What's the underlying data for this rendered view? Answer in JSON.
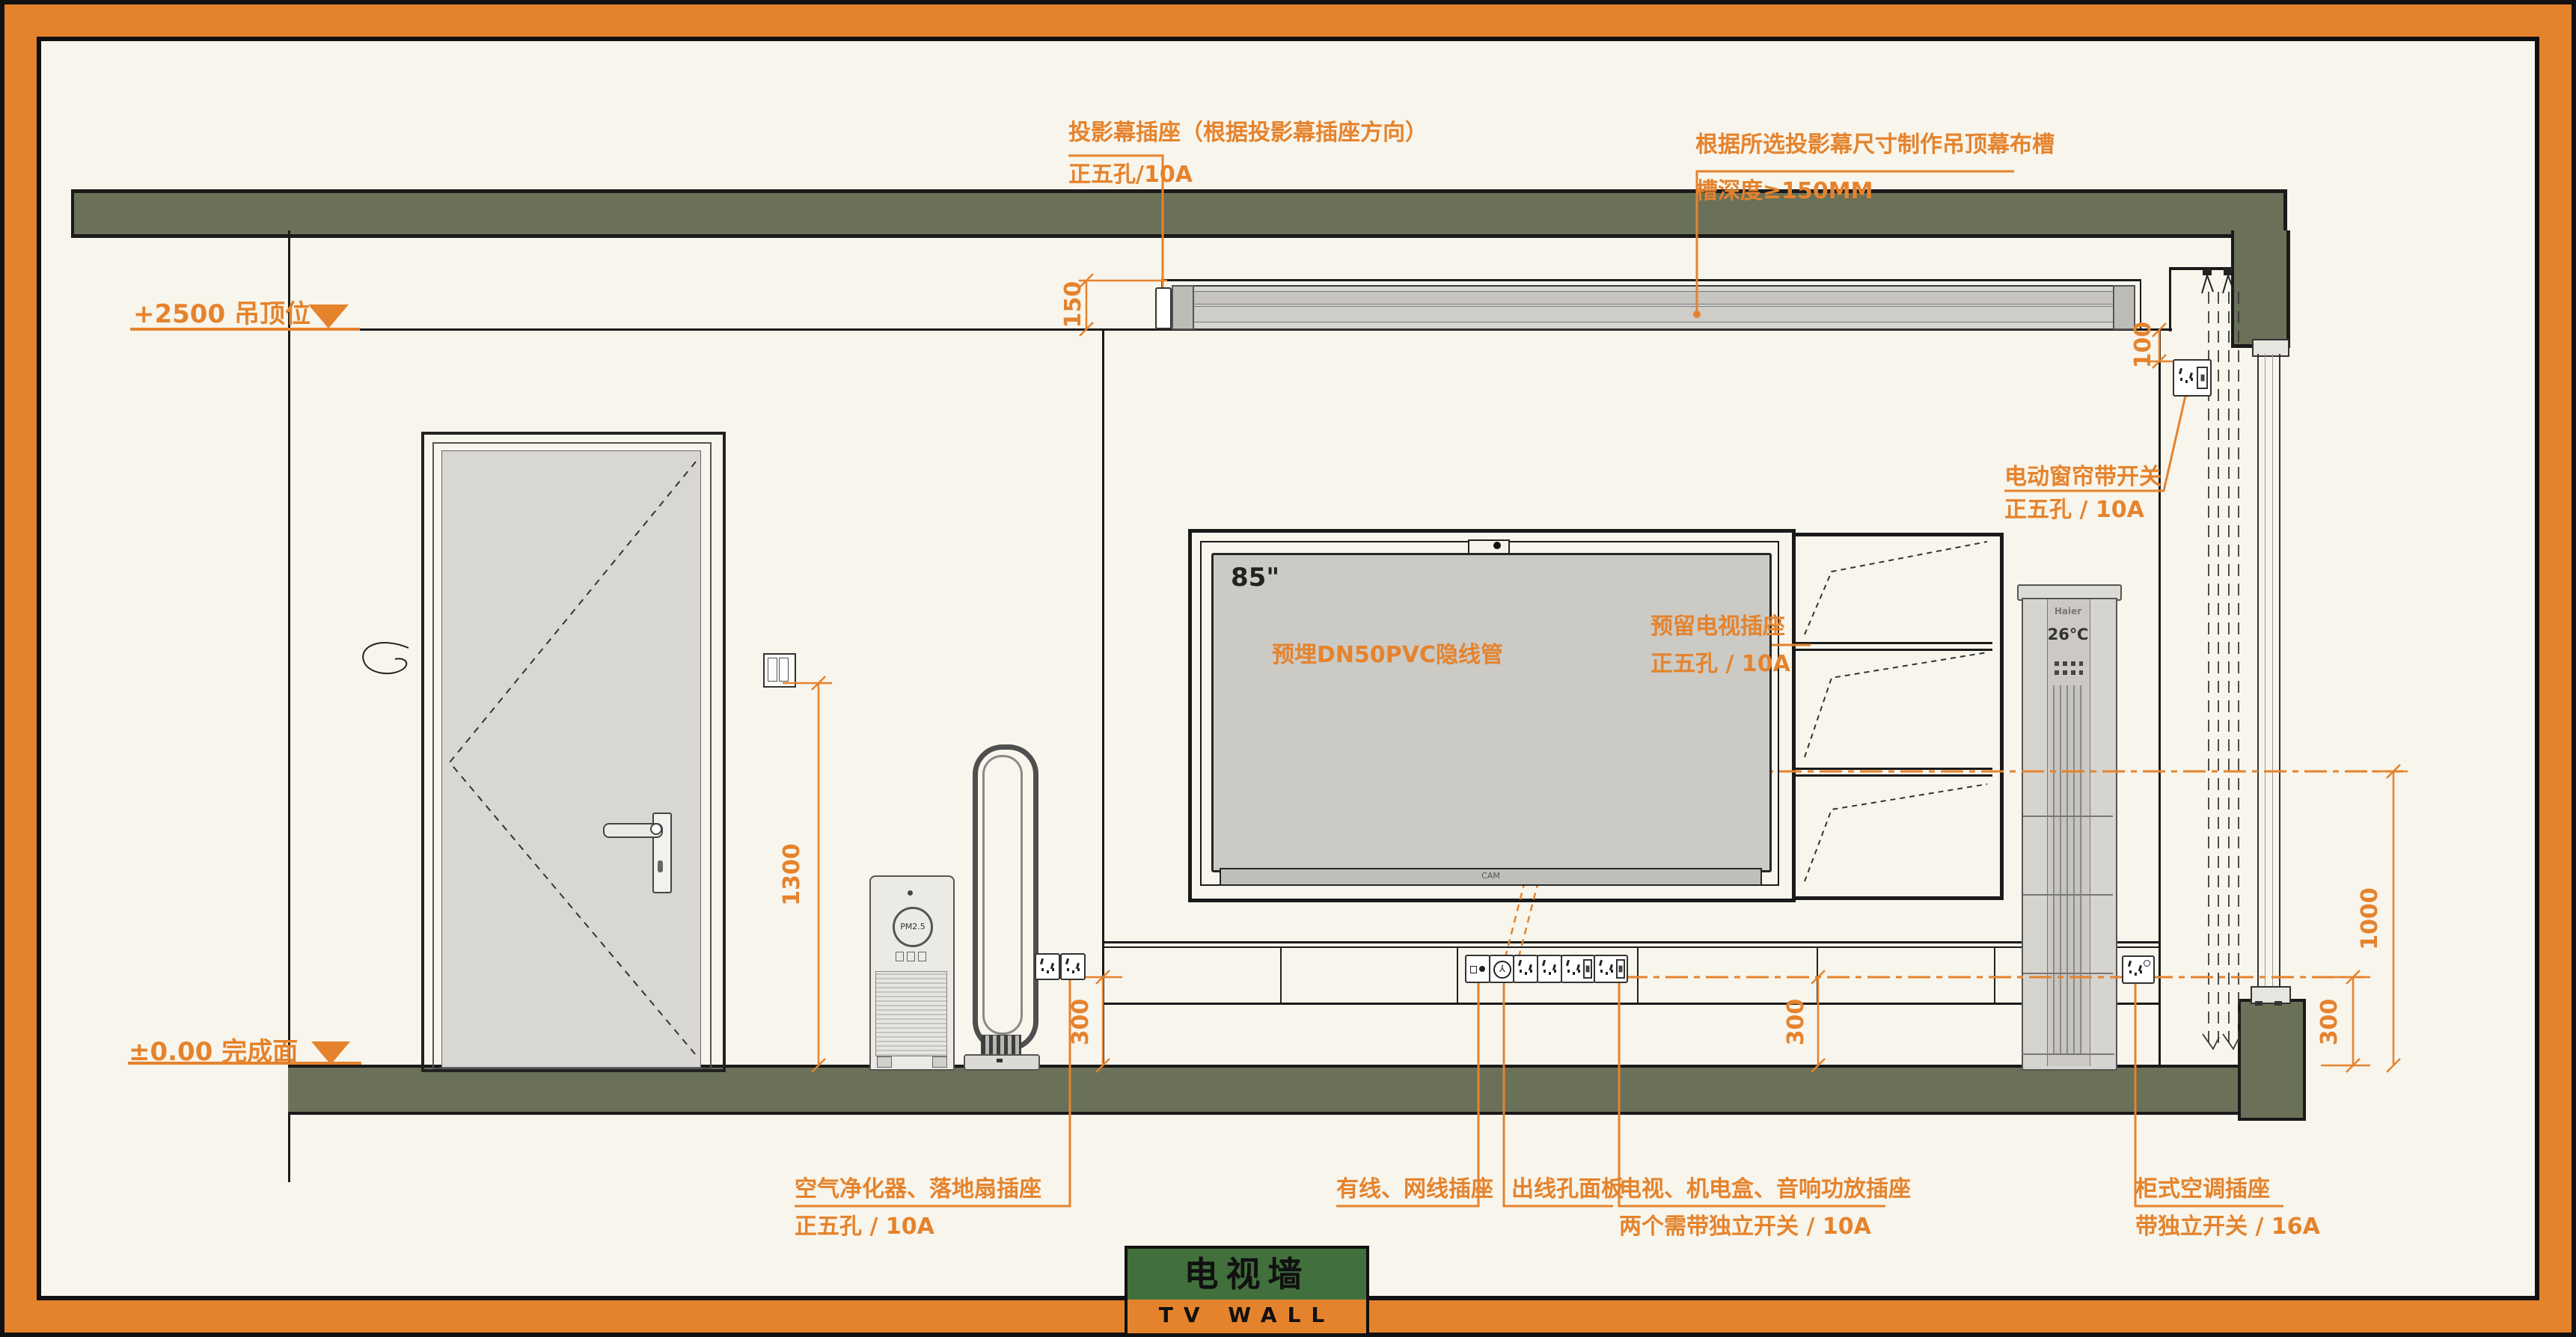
{
  "title": {
    "cn": "电视墙",
    "en": "TV WALL"
  },
  "levels": {
    "ceiling": "+2500 吊顶位",
    "floor": "±0.00 完成面"
  },
  "dims": {
    "slot_depth": "150",
    "curtain_gap": "100",
    "switch_height": "1300",
    "socket_300_left": "300",
    "socket_300_mid": "300",
    "socket_300_right": "300",
    "tv_socket_height": "1000"
  },
  "ann": {
    "projector_socket": {
      "line1": "投影幕插座（根据投影幕插座方向）",
      "line2": "正五孔/10A"
    },
    "screen_slot": {
      "line1": "根据所选投影幕尺寸制作吊顶幕布槽",
      "line2": "槽深度≥150MM"
    },
    "curtain_switch": {
      "line1": "电动窗帘带开关",
      "line2": "正五孔 / 10A"
    },
    "tv_conduit": {
      "line1": "预埋DN50PVC隐线管"
    },
    "tv_socket": {
      "line1": "预留电视插座",
      "line2": "正五孔 / 10A"
    },
    "purifier_socket": {
      "line1": "空气净化器、落地扇插座",
      "line2": "正五孔 / 10A"
    },
    "cable_socket": {
      "line1": "有线、网线插座"
    },
    "outlet_panel": {
      "line1": "出线孔面板"
    },
    "media_socket": {
      "line1": "电视、机电盒、音响功放插座",
      "line2": "两个需带独立开关 / 10A"
    },
    "ac_socket": {
      "line1": "柜式空调插座",
      "line2": "带独立开关 / 16A"
    }
  },
  "equip": {
    "tv_size": "85\"",
    "tv_cam": "CAM",
    "ac_brand": "Haier",
    "ac_temp": "26℃",
    "pm": "PM2.5"
  },
  "colors": {
    "accent": "#E5832D",
    "structure_green": "#6A7158",
    "title_green": "#41703C",
    "paper": "#F8F5EC",
    "ink": "#1A1A1A"
  }
}
